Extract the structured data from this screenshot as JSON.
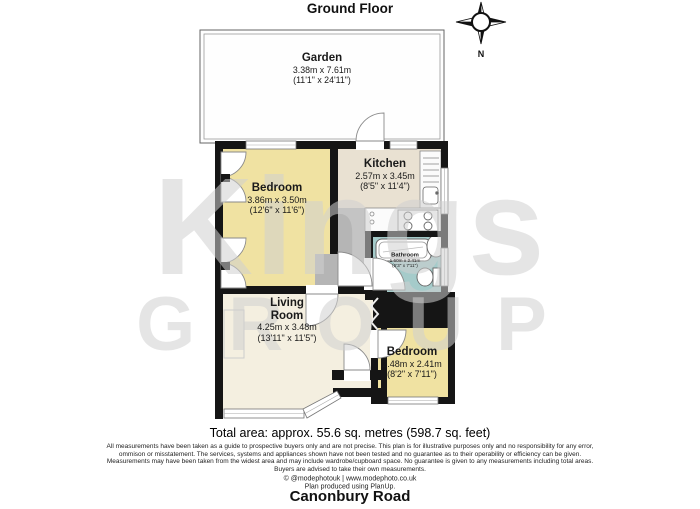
{
  "title": "Ground Floor",
  "address": "Canonbury Road",
  "compass": {
    "label": "N"
  },
  "watermark": {
    "line1": "Kings",
    "line2": "GROUP"
  },
  "rooms": {
    "garden": {
      "name": "Garden",
      "metric": "3.38m x 7.61m",
      "imperial": "(11'1\" x 24'11\")"
    },
    "bedroom1": {
      "name": "Bedroom",
      "metric": "3.86m x 3.50m",
      "imperial": "(12'6\" x 11'6\")"
    },
    "kitchen": {
      "name": "Kitchen",
      "metric": "2.57m x 3.45m",
      "imperial": "(8'5\" x 11'4\")"
    },
    "bathroom": {
      "name": "Bathroom",
      "metric": "1.60m x 2.41m",
      "imperial": "(5'3\" x 7'11\")"
    },
    "living": {
      "name": "Living\nRoom",
      "metric": "4.25m x 3.48m",
      "imperial": "(13'11\" x 11'5\")"
    },
    "bedroom2": {
      "name": "Bedroom",
      "metric": "2.48m x 2.41m",
      "imperial": "(8'2\" x 7'11\")"
    }
  },
  "summary": {
    "total_area": "Total area: approx. 55.6 sq. metres (598.7 sq. feet)"
  },
  "disclaimer": {
    "line1": "All measurements have been taken as a guide to prospective buyers only and are not precise. This plan is for illustrative purposes only and no responsibility for any error,",
    "line2": "ommison or misstatement. The services, systems and appliances shown have not been tested and no guarantee as to their operability or efficiency can be given.",
    "line3": "Measurements may have been taken from the widest area and may include wardrobe/cupboard space. No guarantee is given to any measurements including total areas.",
    "line4": "Buyers are advised to take their own measurements."
  },
  "credits": {
    "line1": "© @modephotouk | www.modephoto.co.uk",
    "line2": "Plan produced using PlanUp."
  },
  "colors": {
    "wall": "#151515",
    "bedroom": "#f0e2a2",
    "kitchen": "#e9e1d2",
    "living": "#f4efe0",
    "bathroom": "#a5cbca",
    "hall": "#b5b5b5"
  }
}
